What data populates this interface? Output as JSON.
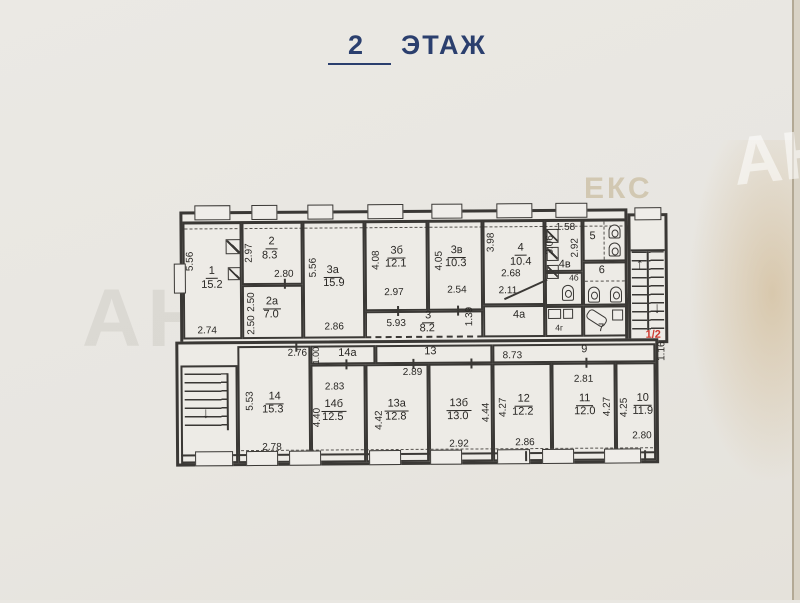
{
  "title": {
    "number": "2",
    "word": "ЭТАЖ"
  },
  "stair_label": "1/2",
  "icons": {
    "arrow_up": "↑",
    "arrow_down": "↓"
  },
  "watermarks": {
    "left": "АН",
    "right_edge": "АН",
    "top_right": "ЕКС",
    "top_right_small": "ость"
  },
  "colors": {
    "title_blue": "#2b3f6e",
    "stair_red": "#cf3a30",
    "line": "#3a3835",
    "paper": "#e9e7e2"
  },
  "rooms": {
    "r1": {
      "num": "1",
      "area": "15.2"
    },
    "r2": {
      "num": "2",
      "area": "8.3"
    },
    "r2a": {
      "num": "2а",
      "area": "7.0"
    },
    "r3": {
      "num": "3",
      "area": "8.2"
    },
    "r3a": {
      "num": "3а",
      "area": "15.9"
    },
    "r3b": {
      "num": "3б",
      "area": "12.1"
    },
    "r3v": {
      "num": "3в",
      "area": "10.3"
    },
    "r4": {
      "num": "4",
      "area": "10.4"
    },
    "r4a": {
      "num": "4а"
    },
    "r4b": {
      "num": "4б"
    },
    "r4v": {
      "num": "4в"
    },
    "r4g": {
      "num": "4г"
    },
    "r5": {
      "num": "5"
    },
    "r6": {
      "num": "6"
    },
    "r7": {
      "num": "7"
    },
    "r9": {
      "num": "9"
    },
    "r10": {
      "num": "10",
      "area": "11.9"
    },
    "r11": {
      "num": "11",
      "area": "12.0"
    },
    "r12": {
      "num": "12",
      "area": "12.2"
    },
    "r13": {
      "num": "13"
    },
    "r13a": {
      "num": "13а",
      "area": "12.8"
    },
    "r13b": {
      "num": "13б",
      "area": "13.0"
    },
    "r14": {
      "num": "14",
      "area": "15.3"
    },
    "r14a": {
      "num": "14а"
    },
    "r14b": {
      "num": "14б",
      "area": "12.5"
    }
  },
  "dims": {
    "r1_h": "5.56",
    "r1_w": "2.74",
    "r2_h": "2.97",
    "r2_w": "2.80",
    "r2a_h": "2.50",
    "r2a_h2": "2.50",
    "r3a_h": "5.56",
    "r3a_w": "2.86",
    "r3b_h": "4.08",
    "r3b_w": "2.97",
    "r3v_h": "4.05",
    "r3v_w": "2.54",
    "r3_w": "5.93",
    "r3_h": "1.39",
    "r4_h": "3.98",
    "r4_w1": "2.68",
    "r4_w2": "2.11",
    "r4v_w": "1.58",
    "r4v_h1": "3.06",
    "r4v_h2": "2.92",
    "c9_w": "8.73",
    "c9_h": "1.16",
    "c14a_h": "1.00",
    "r14_t": "2.76",
    "r14_h": "5.53",
    "r14_b": "2.78",
    "r14b_t": "2.83",
    "r14b_h": "4.40",
    "r13a_t": "2.89",
    "r13a_h": "4.42",
    "r13b_h": "4.44",
    "r13b_b": "2.92",
    "r12_h": "4.27",
    "r12_b": "2.86",
    "r11_t": "2.81",
    "r11_h": "4.27",
    "r10_h": "4.25",
    "r10_b": "2.80"
  }
}
